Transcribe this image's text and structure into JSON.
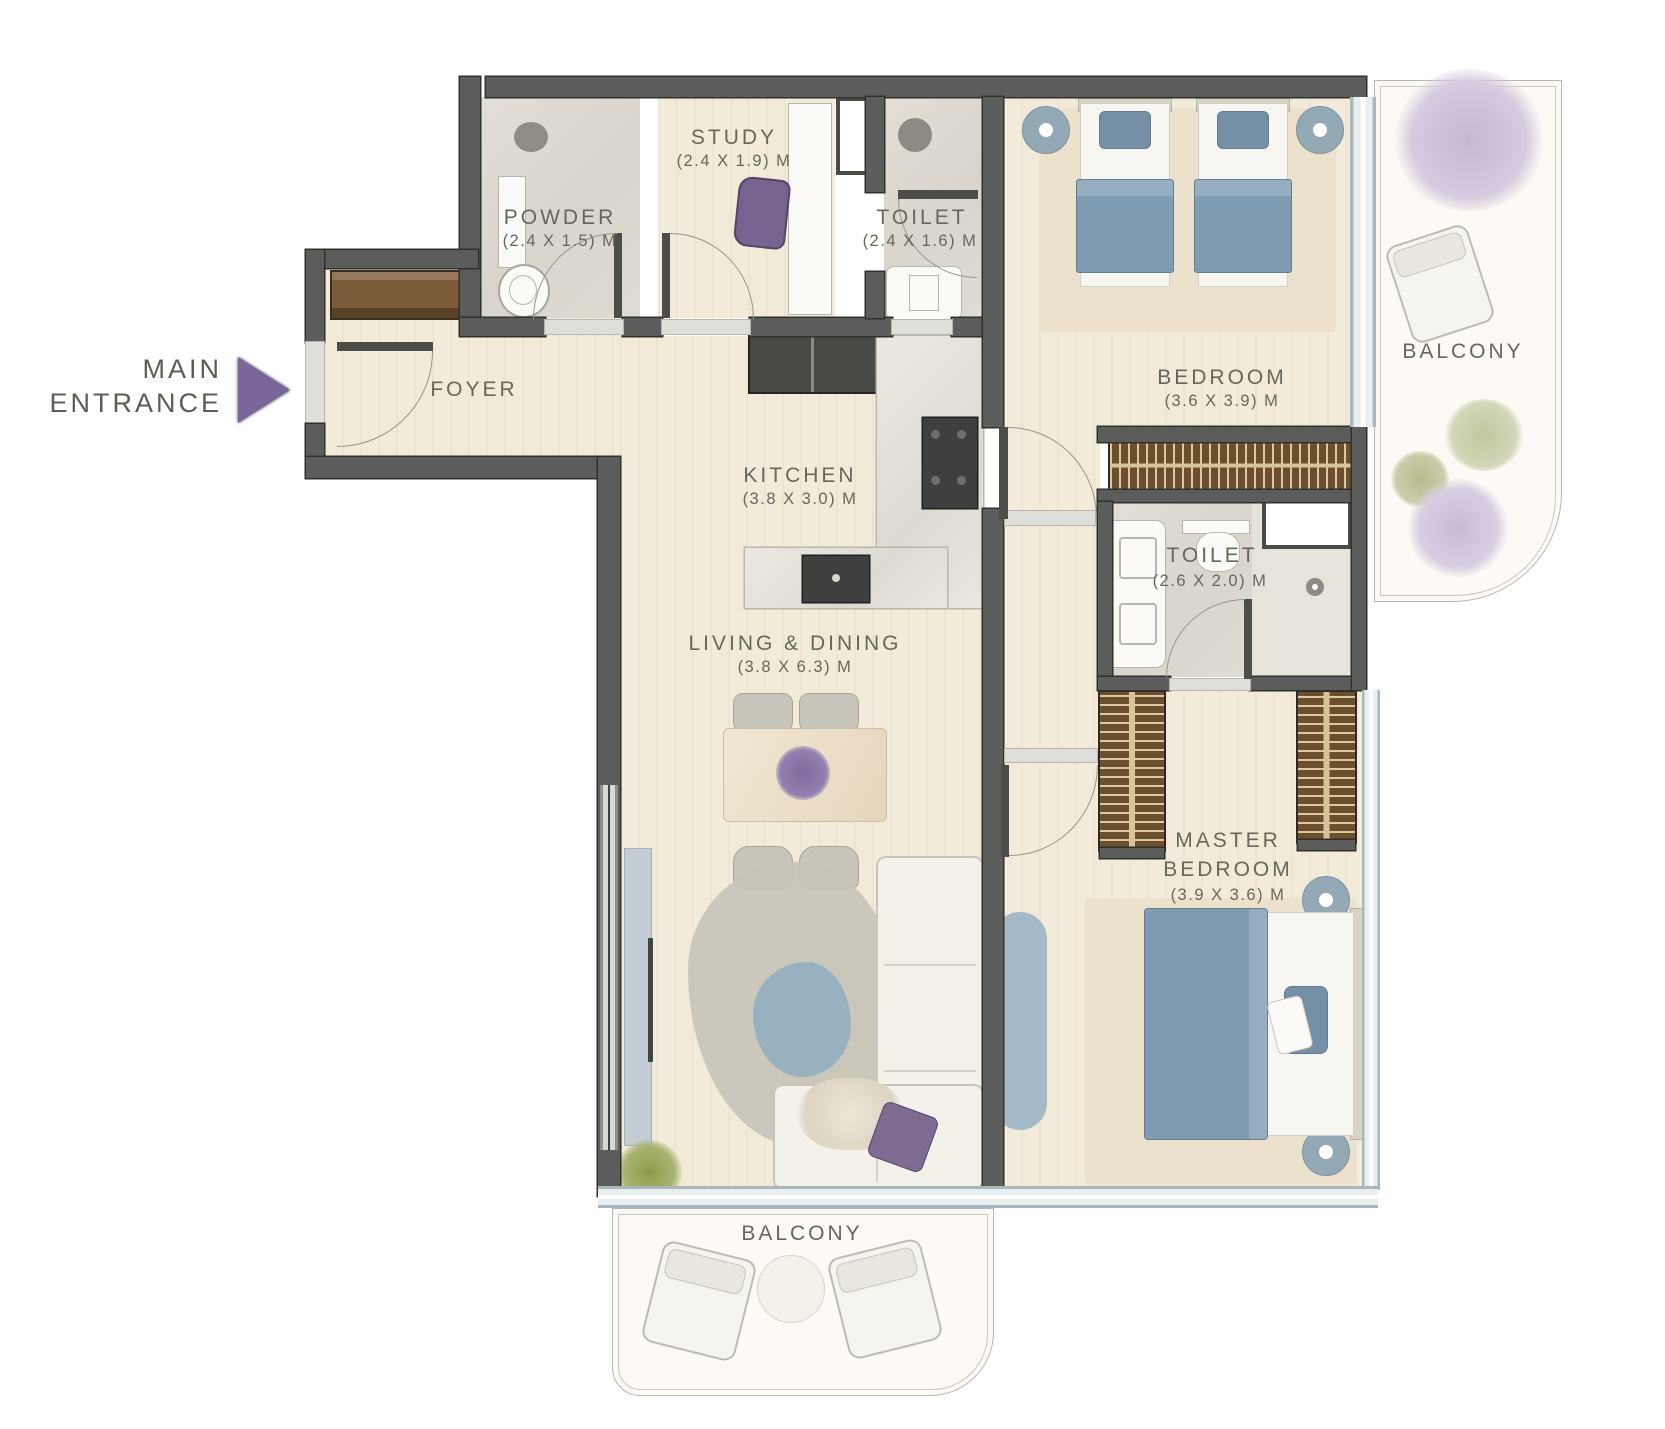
{
  "entrance": {
    "line1": "MAIN",
    "line2": "ENTRANCE"
  },
  "rooms": {
    "foyer": {
      "name": "FOYER"
    },
    "powder": {
      "name": "POWDER",
      "dims": "(2.4 X 1.5) M"
    },
    "study": {
      "name": "STUDY",
      "dims": "(2.4 X 1.9) M"
    },
    "toilet_top": {
      "name": "TOILET",
      "dims": "(2.4 X 1.6) M"
    },
    "bedroom": {
      "name": "BEDROOM",
      "dims": "(3.6 X 3.9) M"
    },
    "kitchen": {
      "name": "KITCHEN",
      "dims": "(3.8 X 3.0) M"
    },
    "toilet_master": {
      "name": "TOILET",
      "dims": "(2.6 X 2.0) M"
    },
    "living": {
      "name": "LIVING & DINING",
      "dims": "(3.8 X 6.3) M"
    },
    "master": {
      "name": "MASTER BEDROOM",
      "dims": "(3.9 X 3.6) M"
    },
    "balcony_right": {
      "name": "BALCONY"
    },
    "balcony_bottom": {
      "name": "BALCONY"
    }
  },
  "colors": {
    "wall": "#5c5c5a",
    "floor": "#f2ebd9",
    "bathroom_floor": "#dcd8cf",
    "balcony_floor": "#fdf9f4",
    "accent_purple": "#7a6699",
    "bedding_blue": "#7f9cb2",
    "wardrobe_brown": "#6b4f2e",
    "glass": "#c2cfd6",
    "label_text": "#67675c"
  }
}
